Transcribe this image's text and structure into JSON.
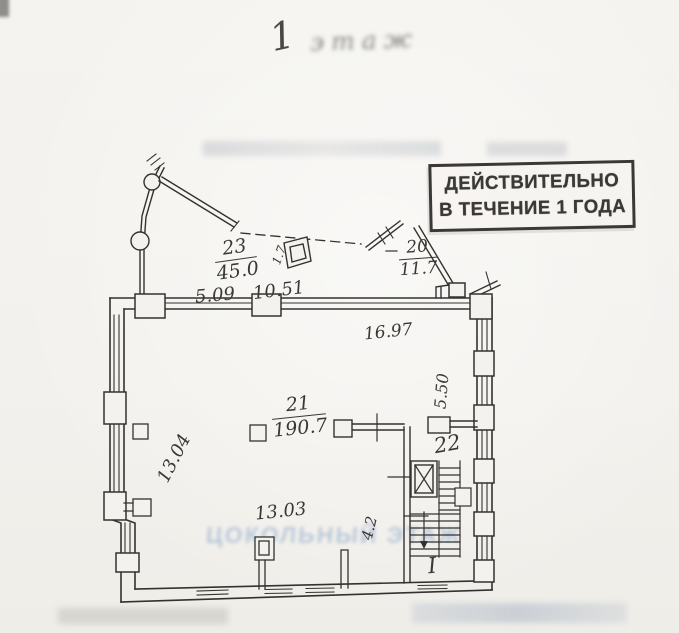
{
  "page": {
    "title_number": "1",
    "title_word": "этаж"
  },
  "stamp": {
    "line1": "ДЕЙСТВИТЕЛЬНО",
    "line2": "В ТЕЧЕНИЕ 1 ГОДА"
  },
  "rooms": {
    "r23": {
      "num": "23",
      "area": "45.0"
    },
    "r20": {
      "num": "20",
      "area": "11.7"
    },
    "r21": {
      "num": "21",
      "area": "190.7"
    },
    "r22": {
      "num": "22"
    }
  },
  "dimensions": {
    "top_left": "5.09",
    "top_mid": "10.51",
    "top_right": "16.97",
    "right_vertical": "5.50",
    "left_vertical": "13.04",
    "bottom": "13.03",
    "inner_vertical": "4.2",
    "booth": "1.7"
  },
  "stairs": {
    "flight_label": "I"
  },
  "watermark": {
    "basement_text": "ЦОКОЛЬНЫЙ ЭТАЖ"
  },
  "colors": {
    "ink": "#34322f",
    "paper": "#f3f1ed",
    "stamp_ink": "#3b3936",
    "watermark_blue": "#6f93bf"
  }
}
